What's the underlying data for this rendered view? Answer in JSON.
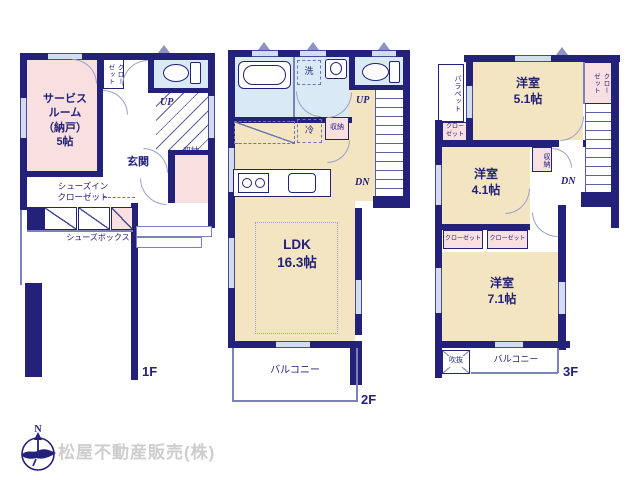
{
  "colors": {
    "wall": "#23217a",
    "room_pink": "#f8dfe0",
    "room_cream": "#f3e5c1",
    "room_blue": "#d9e9f6",
    "line_purple": "#7d82b8",
    "watermark_gray": "#cdcdcd"
  },
  "footer": {
    "company": "松屋不動産販売(株)",
    "compass": "N"
  },
  "f1": {
    "floor_label": "1F",
    "service_room": "サービス\nルーム\n（納戸）\n5帖",
    "closet": "クロー\nゼット",
    "entrance": "玄関",
    "storage": "収納",
    "up": "UP",
    "shoes_closet": "シューズイン\nクローゼット",
    "shoes_box": "シューズボックス"
  },
  "f2": {
    "floor_label": "2F",
    "ldk": "LDK\n16.3帖",
    "laundry": "洗",
    "fridge": "冷",
    "storage": "収納",
    "balcony": "バルコニー",
    "up": "UP",
    "dn": "DN"
  },
  "f3": {
    "floor_label": "3F",
    "parapet": "パラペット",
    "room_5_1": "洋室\n5.1帖",
    "closet_top_right": "クロー\nゼット",
    "closet_left": "クロー\nゼット",
    "room_4_1": "洋室\n4.1帖",
    "storage": "収納",
    "dn": "DN",
    "closet_a": "クローゼット",
    "closet_b": "クローゼット",
    "room_7_1": "洋室\n7.1帖",
    "void": "吹抜",
    "balcony": "バルコニー"
  }
}
